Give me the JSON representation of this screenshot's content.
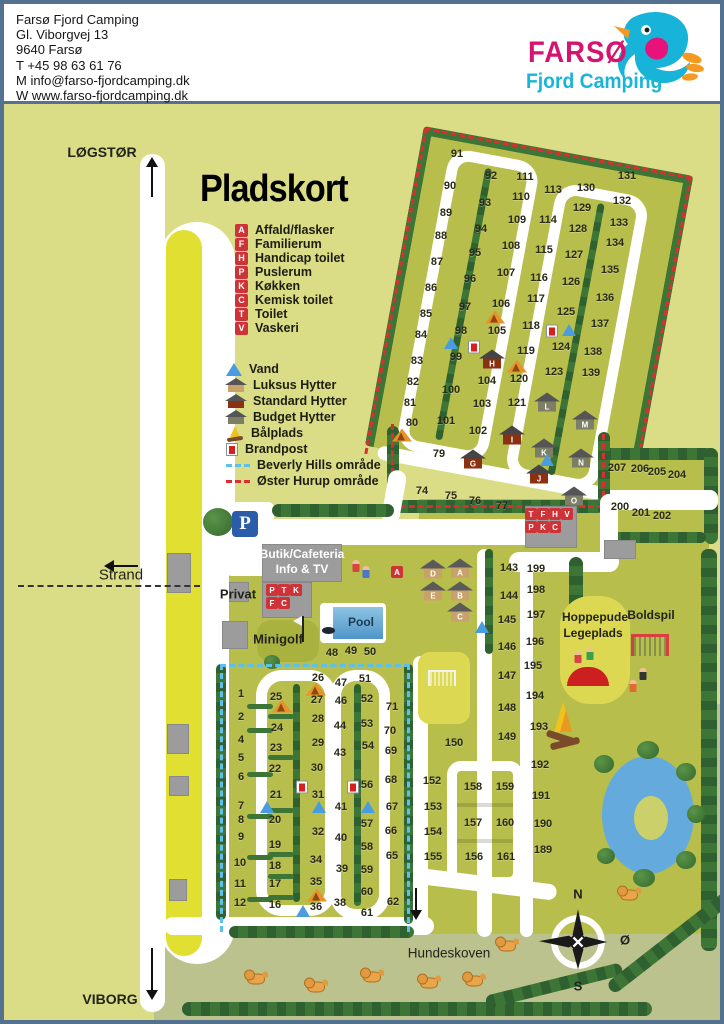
{
  "header": {
    "lines": [
      "Farsø Fjord Camping",
      "Gl. Viborgvej 13",
      "9640 Farsø",
      "T +45 98 63 61 76",
      "M info@farso-fjordcamping.dk",
      "W www.farso-fjordcamping.dk"
    ],
    "logo": {
      "name": "FARSØ",
      "sub": "Fjord Camping"
    }
  },
  "colors": {
    "legend_red": "#cf3338",
    "oster_red": "#d63030",
    "beverly_blue": "#5bc0ea",
    "water_blue": "#5a9fd0",
    "logo_pink": "#d6136e",
    "logo_cyan": "#19b5d9"
  },
  "map": {
    "labels": {
      "pladskort": "Pladskort",
      "logstor": "LØGSTØR",
      "viborg": "VIBORG",
      "strand": "Strand",
      "privat": "Privat",
      "butik1": "Butik/Cafeteria",
      "butik2": "Info & TV",
      "minigolf": "Minigolf",
      "pool": "Pool",
      "hoppepude1": "Hoppepude",
      "hoppepude2": "Legeplads",
      "boldspil": "Boldspil",
      "hundeskoven": "Hundeskoven",
      "parking": "P"
    },
    "compass": {
      "n": "N",
      "oe": "Ø",
      "s": "S"
    },
    "legend_letters": [
      {
        "c": "A",
        "label": "Affald/flasker"
      },
      {
        "c": "F",
        "label": "Familierum"
      },
      {
        "c": "H",
        "label": "Handicap toilet"
      },
      {
        "c": "P",
        "label": "Puslerum"
      },
      {
        "c": "K",
        "label": "Køkken"
      },
      {
        "c": "C",
        "label": "Kemisk toilet"
      },
      {
        "c": "T",
        "label": "Toilet"
      },
      {
        "c": "V",
        "label": "Vaskeri"
      }
    ],
    "legend_symbols": [
      {
        "icon": "vand",
        "label": "Vand"
      },
      {
        "icon": "hut-luksus",
        "label": "Luksus Hytter"
      },
      {
        "icon": "hut-standard",
        "label": "Standard Hytter"
      },
      {
        "icon": "hut-budget",
        "label": "Budget Hytter"
      },
      {
        "icon": "fire",
        "label": "Bålplads"
      },
      {
        "icon": "brandpost",
        "label": "Brandpost"
      },
      {
        "icon": "dash-blue",
        "label": "Beverly Hills område"
      },
      {
        "icon": "dash-red",
        "label": "Øster Hurup område"
      }
    ],
    "service_building_rows": [
      {
        "y": 510,
        "x0": 527,
        "step": 12,
        "letters": [
          "T",
          "F",
          "H",
          "V"
        ]
      },
      {
        "y": 523,
        "x0": 527,
        "step": 12,
        "letters": [
          "P",
          "K",
          "C"
        ]
      }
    ],
    "butik_rows": [
      {
        "y": 586,
        "x0": 268,
        "step": 12,
        "letters": [
          "P",
          "T",
          "K"
        ]
      },
      {
        "y": 599,
        "x0": 268,
        "step": 12,
        "letters": [
          "F",
          "C"
        ]
      }
    ],
    "standalone_letters": [
      {
        "l": "A",
        "x": 393,
        "y": 568
      }
    ],
    "pitches": [
      {
        "n": "91",
        "x": 453,
        "y": 150
      },
      {
        "n": "90",
        "x": 446,
        "y": 182
      },
      {
        "n": "89",
        "x": 442,
        "y": 209
      },
      {
        "n": "88",
        "x": 437,
        "y": 232
      },
      {
        "n": "87",
        "x": 433,
        "y": 258
      },
      {
        "n": "86",
        "x": 427,
        "y": 284
      },
      {
        "n": "85",
        "x": 422,
        "y": 310
      },
      {
        "n": "84",
        "x": 417,
        "y": 331
      },
      {
        "n": "83",
        "x": 413,
        "y": 357
      },
      {
        "n": "82",
        "x": 409,
        "y": 378
      },
      {
        "n": "81",
        "x": 406,
        "y": 399
      },
      {
        "n": "80",
        "x": 408,
        "y": 419
      },
      {
        "n": "79",
        "x": 435,
        "y": 450
      },
      {
        "n": "92",
        "x": 487,
        "y": 172
      },
      {
        "n": "93",
        "x": 481,
        "y": 199
      },
      {
        "n": "94",
        "x": 477,
        "y": 225
      },
      {
        "n": "95",
        "x": 471,
        "y": 249
      },
      {
        "n": "96",
        "x": 466,
        "y": 275
      },
      {
        "n": "97",
        "x": 461,
        "y": 303
      },
      {
        "n": "98",
        "x": 457,
        "y": 327
      },
      {
        "n": "99",
        "x": 452,
        "y": 353
      },
      {
        "n": "100",
        "x": 447,
        "y": 386
      },
      {
        "n": "101",
        "x": 442,
        "y": 417
      },
      {
        "n": "111",
        "x": 521,
        "y": 173
      },
      {
        "n": "110",
        "x": 517,
        "y": 193
      },
      {
        "n": "109",
        "x": 513,
        "y": 216
      },
      {
        "n": "108",
        "x": 507,
        "y": 242
      },
      {
        "n": "107",
        "x": 502,
        "y": 269
      },
      {
        "n": "106",
        "x": 497,
        "y": 300
      },
      {
        "n": "105",
        "x": 493,
        "y": 327
      },
      {
        "n": "104",
        "x": 483,
        "y": 377
      },
      {
        "n": "103",
        "x": 478,
        "y": 400
      },
      {
        "n": "102",
        "x": 474,
        "y": 427
      },
      {
        "n": "113",
        "x": 549,
        "y": 186
      },
      {
        "n": "114",
        "x": 544,
        "y": 216
      },
      {
        "n": "115",
        "x": 540,
        "y": 246
      },
      {
        "n": "116",
        "x": 535,
        "y": 274
      },
      {
        "n": "117",
        "x": 532,
        "y": 295
      },
      {
        "n": "118",
        "x": 527,
        "y": 322
      },
      {
        "n": "119",
        "x": 522,
        "y": 347
      },
      {
        "n": "120",
        "x": 515,
        "y": 375
      },
      {
        "n": "121",
        "x": 513,
        "y": 399
      },
      {
        "n": "130",
        "x": 582,
        "y": 184
      },
      {
        "n": "129",
        "x": 578,
        "y": 204
      },
      {
        "n": "128",
        "x": 574,
        "y": 225
      },
      {
        "n": "127",
        "x": 570,
        "y": 251
      },
      {
        "n": "126",
        "x": 567,
        "y": 278
      },
      {
        "n": "125",
        "x": 562,
        "y": 308
      },
      {
        "n": "124",
        "x": 557,
        "y": 343
      },
      {
        "n": "123",
        "x": 550,
        "y": 368
      },
      {
        "n": "131",
        "x": 623,
        "y": 172
      },
      {
        "n": "132",
        "x": 618,
        "y": 197
      },
      {
        "n": "133",
        "x": 615,
        "y": 219
      },
      {
        "n": "134",
        "x": 611,
        "y": 239
      },
      {
        "n": "135",
        "x": 606,
        "y": 266
      },
      {
        "n": "136",
        "x": 601,
        "y": 294
      },
      {
        "n": "137",
        "x": 596,
        "y": 320
      },
      {
        "n": "138",
        "x": 589,
        "y": 348
      },
      {
        "n": "139",
        "x": 587,
        "y": 369
      },
      {
        "n": "74",
        "x": 418,
        "y": 487
      },
      {
        "n": "75",
        "x": 447,
        "y": 492
      },
      {
        "n": "76",
        "x": 471,
        "y": 497
      },
      {
        "n": "77",
        "x": 498,
        "y": 502
      },
      {
        "n": "207",
        "x": 613,
        "y": 464
      },
      {
        "n": "206",
        "x": 636,
        "y": 465
      },
      {
        "n": "205",
        "x": 653,
        "y": 468
      },
      {
        "n": "204",
        "x": 673,
        "y": 471
      },
      {
        "n": "200",
        "x": 616,
        "y": 503
      },
      {
        "n": "201",
        "x": 637,
        "y": 509
      },
      {
        "n": "202",
        "x": 658,
        "y": 512
      },
      {
        "n": "199",
        "x": 532,
        "y": 565
      },
      {
        "n": "198",
        "x": 532,
        "y": 586
      },
      {
        "n": "197",
        "x": 532,
        "y": 611
      },
      {
        "n": "196",
        "x": 531,
        "y": 638
      },
      {
        "n": "195",
        "x": 529,
        "y": 662
      },
      {
        "n": "194",
        "x": 531,
        "y": 692
      },
      {
        "n": "193",
        "x": 535,
        "y": 723
      },
      {
        "n": "192",
        "x": 536,
        "y": 761
      },
      {
        "n": "191",
        "x": 537,
        "y": 792
      },
      {
        "n": "190",
        "x": 539,
        "y": 820
      },
      {
        "n": "189",
        "x": 539,
        "y": 846
      },
      {
        "n": "143",
        "x": 505,
        "y": 564
      },
      {
        "n": "144",
        "x": 505,
        "y": 592
      },
      {
        "n": "145",
        "x": 503,
        "y": 616
      },
      {
        "n": "146",
        "x": 503,
        "y": 643
      },
      {
        "n": "147",
        "x": 503,
        "y": 672
      },
      {
        "n": "148",
        "x": 503,
        "y": 704
      },
      {
        "n": "149",
        "x": 503,
        "y": 733
      },
      {
        "n": "150",
        "x": 450,
        "y": 739
      },
      {
        "n": "152",
        "x": 428,
        "y": 777
      },
      {
        "n": "153",
        "x": 429,
        "y": 803
      },
      {
        "n": "154",
        "x": 429,
        "y": 828
      },
      {
        "n": "155",
        "x": 429,
        "y": 853
      },
      {
        "n": "158",
        "x": 469,
        "y": 783
      },
      {
        "n": "159",
        "x": 501,
        "y": 783
      },
      {
        "n": "157",
        "x": 469,
        "y": 819
      },
      {
        "n": "160",
        "x": 501,
        "y": 819
      },
      {
        "n": "156",
        "x": 470,
        "y": 853
      },
      {
        "n": "161",
        "x": 502,
        "y": 853
      },
      {
        "n": "71",
        "x": 388,
        "y": 703
      },
      {
        "n": "70",
        "x": 386,
        "y": 727
      },
      {
        "n": "69",
        "x": 387,
        "y": 747
      },
      {
        "n": "68",
        "x": 387,
        "y": 776
      },
      {
        "n": "67",
        "x": 388,
        "y": 803
      },
      {
        "n": "66",
        "x": 387,
        "y": 827
      },
      {
        "n": "65",
        "x": 388,
        "y": 852
      },
      {
        "n": "62",
        "x": 389,
        "y": 898
      },
      {
        "n": "1",
        "x": 237,
        "y": 690
      },
      {
        "n": "2",
        "x": 237,
        "y": 713
      },
      {
        "n": "4",
        "x": 237,
        "y": 736
      },
      {
        "n": "5",
        "x": 237,
        "y": 754
      },
      {
        "n": "6",
        "x": 237,
        "y": 773
      },
      {
        "n": "7",
        "x": 237,
        "y": 802
      },
      {
        "n": "8",
        "x": 237,
        "y": 816
      },
      {
        "n": "9",
        "x": 237,
        "y": 833
      },
      {
        "n": "10",
        "x": 236,
        "y": 859
      },
      {
        "n": "11",
        "x": 236,
        "y": 880
      },
      {
        "n": "12",
        "x": 236,
        "y": 899
      },
      {
        "n": "25",
        "x": 272,
        "y": 693
      },
      {
        "n": "24",
        "x": 273,
        "y": 724
      },
      {
        "n": "23",
        "x": 272,
        "y": 744
      },
      {
        "n": "22",
        "x": 271,
        "y": 765
      },
      {
        "n": "21",
        "x": 272,
        "y": 791
      },
      {
        "n": "20",
        "x": 271,
        "y": 816
      },
      {
        "n": "19",
        "x": 271,
        "y": 841
      },
      {
        "n": "18",
        "x": 271,
        "y": 862
      },
      {
        "n": "17",
        "x": 271,
        "y": 880
      },
      {
        "n": "16",
        "x": 271,
        "y": 901
      },
      {
        "n": "26",
        "x": 314,
        "y": 674
      },
      {
        "n": "27",
        "x": 313,
        "y": 696
      },
      {
        "n": "28",
        "x": 314,
        "y": 715
      },
      {
        "n": "29",
        "x": 314,
        "y": 739
      },
      {
        "n": "30",
        "x": 313,
        "y": 764
      },
      {
        "n": "31",
        "x": 314,
        "y": 791
      },
      {
        "n": "32",
        "x": 314,
        "y": 828
      },
      {
        "n": "34",
        "x": 312,
        "y": 856
      },
      {
        "n": "35",
        "x": 312,
        "y": 878
      },
      {
        "n": "36",
        "x": 312,
        "y": 903
      },
      {
        "n": "47",
        "x": 337,
        "y": 679
      },
      {
        "n": "46",
        "x": 337,
        "y": 697
      },
      {
        "n": "44",
        "x": 336,
        "y": 722
      },
      {
        "n": "43",
        "x": 336,
        "y": 749
      },
      {
        "n": "41",
        "x": 337,
        "y": 803
      },
      {
        "n": "40",
        "x": 337,
        "y": 834
      },
      {
        "n": "39",
        "x": 338,
        "y": 865
      },
      {
        "n": "38",
        "x": 336,
        "y": 899
      },
      {
        "n": "51",
        "x": 361,
        "y": 675
      },
      {
        "n": "52",
        "x": 363,
        "y": 695
      },
      {
        "n": "53",
        "x": 363,
        "y": 720
      },
      {
        "n": "54",
        "x": 364,
        "y": 742
      },
      {
        "n": "56",
        "x": 363,
        "y": 781
      },
      {
        "n": "57",
        "x": 363,
        "y": 820
      },
      {
        "n": "58",
        "x": 363,
        "y": 843
      },
      {
        "n": "59",
        "x": 363,
        "y": 866
      },
      {
        "n": "60",
        "x": 363,
        "y": 888
      },
      {
        "n": "61",
        "x": 363,
        "y": 909
      },
      {
        "n": "48",
        "x": 328,
        "y": 649
      },
      {
        "n": "49",
        "x": 347,
        "y": 647
      },
      {
        "n": "50",
        "x": 366,
        "y": 648
      }
    ],
    "huts": [
      {
        "letter": "D",
        "type": "luksus",
        "x": 429,
        "y": 565
      },
      {
        "letter": "A",
        "type": "luksus",
        "x": 456,
        "y": 564
      },
      {
        "letter": "E",
        "type": "luksus",
        "x": 429,
        "y": 587
      },
      {
        "letter": "B",
        "type": "luksus",
        "x": 456,
        "y": 587
      },
      {
        "letter": "C",
        "type": "luksus",
        "x": 456,
        "y": 608
      },
      {
        "letter": "H",
        "type": "standard",
        "x": 488,
        "y": 355
      },
      {
        "letter": "I",
        "type": "standard",
        "x": 508,
        "y": 431
      },
      {
        "letter": "G",
        "type": "standard",
        "x": 469,
        "y": 455
      },
      {
        "letter": "J",
        "type": "standard",
        "x": 535,
        "y": 470
      },
      {
        "letter": "L",
        "type": "budget",
        "x": 543,
        "y": 398
      },
      {
        "letter": "M",
        "type": "budget",
        "x": 581,
        "y": 416
      },
      {
        "letter": "K",
        "type": "budget",
        "x": 540,
        "y": 444
      },
      {
        "letter": "N",
        "type": "budget",
        "x": 577,
        "y": 454
      },
      {
        "letter": "O",
        "type": "budget",
        "x": 570,
        "y": 492
      }
    ],
    "icons": [
      {
        "t": "vand",
        "x": 447,
        "y": 339
      },
      {
        "t": "vand",
        "x": 565,
        "y": 326
      },
      {
        "t": "vand",
        "x": 543,
        "y": 456
      },
      {
        "t": "vand",
        "x": 478,
        "y": 623
      },
      {
        "t": "vand",
        "x": 263,
        "y": 803
      },
      {
        "t": "vand",
        "x": 315,
        "y": 803
      },
      {
        "t": "vand",
        "x": 364,
        "y": 803
      },
      {
        "t": "vand",
        "x": 299,
        "y": 907
      },
      {
        "t": "tent",
        "x": 398,
        "y": 431
      },
      {
        "t": "tent",
        "x": 491,
        "y": 313
      },
      {
        "t": "tent",
        "x": 513,
        "y": 362
      },
      {
        "t": "tent",
        "x": 278,
        "y": 702
      },
      {
        "t": "tent",
        "x": 312,
        "y": 685
      },
      {
        "t": "tent",
        "x": 313,
        "y": 891
      },
      {
        "t": "brandpost",
        "x": 470,
        "y": 343
      },
      {
        "t": "brandpost",
        "x": 548,
        "y": 327
      },
      {
        "t": "brandpost",
        "x": 298,
        "y": 783
      },
      {
        "t": "brandpost",
        "x": 349,
        "y": 783
      },
      {
        "t": "dog",
        "x": 252,
        "y": 975
      },
      {
        "t": "dog",
        "x": 312,
        "y": 983
      },
      {
        "t": "dog",
        "x": 368,
        "y": 973
      },
      {
        "t": "dog",
        "x": 425,
        "y": 979
      },
      {
        "t": "dog",
        "x": 470,
        "y": 977
      },
      {
        "t": "dog",
        "x": 503,
        "y": 942
      },
      {
        "t": "dog",
        "x": 625,
        "y": 891
      }
    ]
  }
}
